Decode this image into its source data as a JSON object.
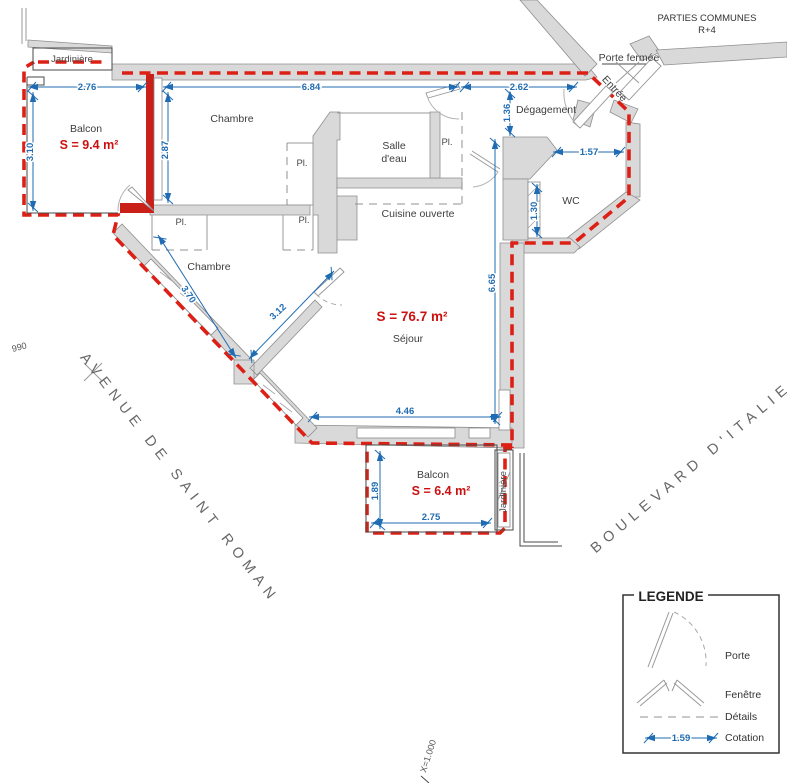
{
  "rooms": {
    "balcon_nw": {
      "label": "Balcon",
      "area": "S = 9.4 m²"
    },
    "chambre_top": {
      "label": "Chambre"
    },
    "chambre_mid": {
      "label": "Chambre"
    },
    "salle_eau": {
      "line1": "Salle",
      "line2": "d'eau"
    },
    "cuisine": {
      "label": "Cuisine ouverte"
    },
    "degagement": {
      "label": "Dégagement"
    },
    "wc": {
      "label": "WC"
    },
    "sejour": {
      "label": "Séjour",
      "area": "S = 76.7 m²"
    },
    "balcon_s": {
      "label": "Balcon",
      "area": "S = 6.4 m²"
    },
    "placard": {
      "label": "Pl."
    },
    "jardiniere": {
      "label": "Jardinière"
    }
  },
  "annotations": {
    "parties_communes": {
      "line1": "PARTIES COMMUNES",
      "line2": "R+4"
    },
    "porte_fermee": "Porte fermée",
    "entree": "Entrée",
    "coord_990": "990",
    "coord_x": "X=1.000"
  },
  "streets": {
    "avenue": "AVENUE DE SAINT ROMAN",
    "boulevard": "BOULEVARD D'ITALIE"
  },
  "dimensions": {
    "balcon_nw_w": "2.76",
    "balcon_nw_h": "3.10",
    "chambre_top_w": "6.84",
    "chambre_top_h": "2.87",
    "degagement_w": "2.62",
    "degagement_h": "1.36",
    "wc_w": "1.57",
    "wc_h": "1.30",
    "sejour_e": "6.65",
    "chambre_mid_a": "3.70",
    "chambre_mid_b": "3.12",
    "sejour_s": "4.46",
    "balcon_s_h": "1.89",
    "balcon_s_w": "2.75"
  },
  "legend": {
    "title": "LEGENDE",
    "items": [
      {
        "label": "Porte"
      },
      {
        "label": "Fenêtre"
      },
      {
        "label": "Détails"
      },
      {
        "label": "Cotation"
      }
    ],
    "sample_dimension": "1.59"
  },
  "colors": {
    "boundary_red": "#dd2016",
    "wall_red": "#c9201a",
    "dimension_blue": "#1f6cb3",
    "area_red": "#cc1111",
    "wall_gray": "#d9d9d9"
  }
}
